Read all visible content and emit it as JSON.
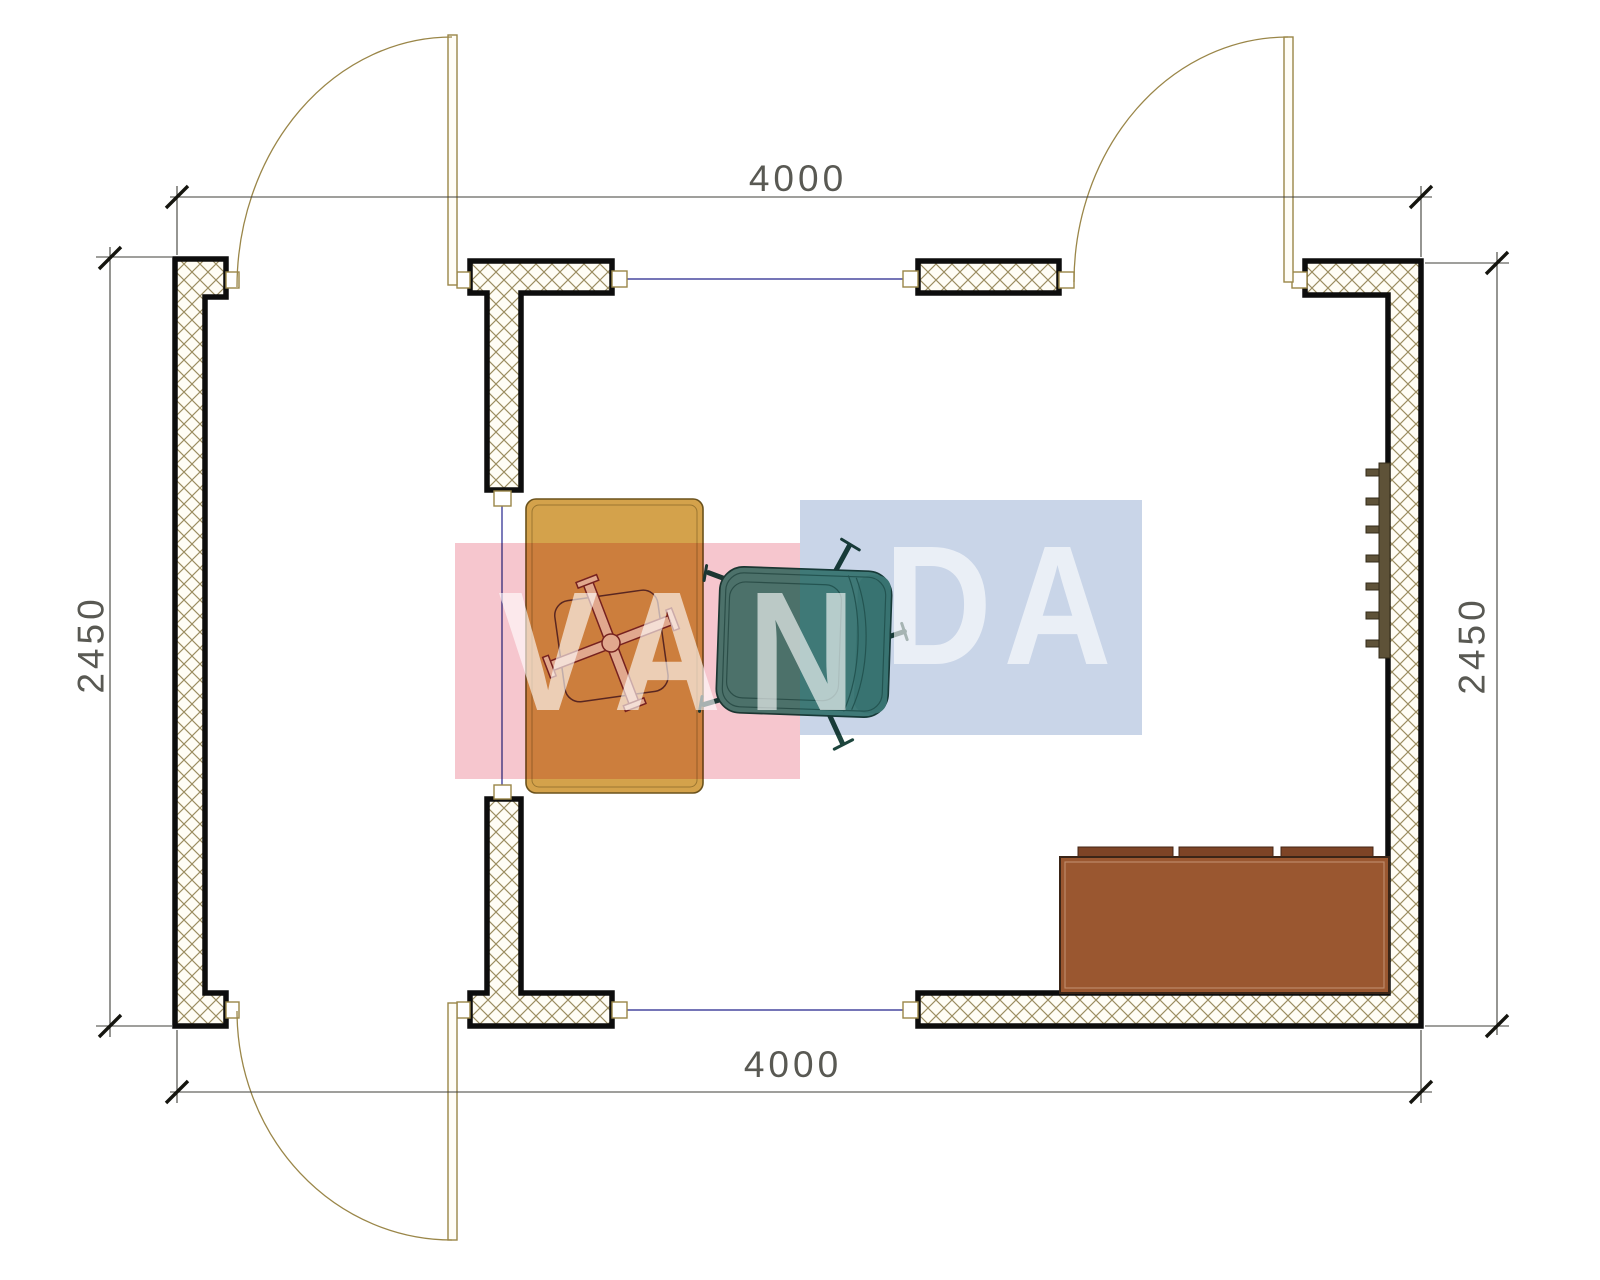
{
  "drawing": {
    "type": "architectural floor plan, top view",
    "room_width_mm": "4000",
    "room_depth_mm": "2450"
  },
  "dimensions": {
    "top": "4000",
    "bottom": "4000",
    "left": "2450",
    "right": "2450"
  },
  "watermark": {
    "text_full": "VANDA",
    "text_left": "VAN",
    "text_right": "DA",
    "pink": "#f6c6ce",
    "blue": "#c9d5e8",
    "letter_color": "rgba(255,255,255,0.62)"
  },
  "colors": {
    "wall_hatch_line": "#9b8d60",
    "wall_fill": "#fffdf5",
    "wall_outline": "#0d0d0d",
    "door_frame_tan": "#9a8648",
    "opening_line_blue": "#23238c",
    "desk": "#d4a24b",
    "chair_cross_fill": "#ead9b0",
    "armchair": "#4f9183",
    "armchair_back_band": "#478a7c",
    "sofa": "#9a5730",
    "sofa_cushion": "#7d4426",
    "radiator": "#5e5238",
    "dim_text": "#4b4b45"
  },
  "furniture": [
    {
      "name": "desk"
    },
    {
      "name": "office-chair"
    },
    {
      "name": "armchair"
    },
    {
      "name": "sofa"
    },
    {
      "name": "radiator"
    }
  ]
}
